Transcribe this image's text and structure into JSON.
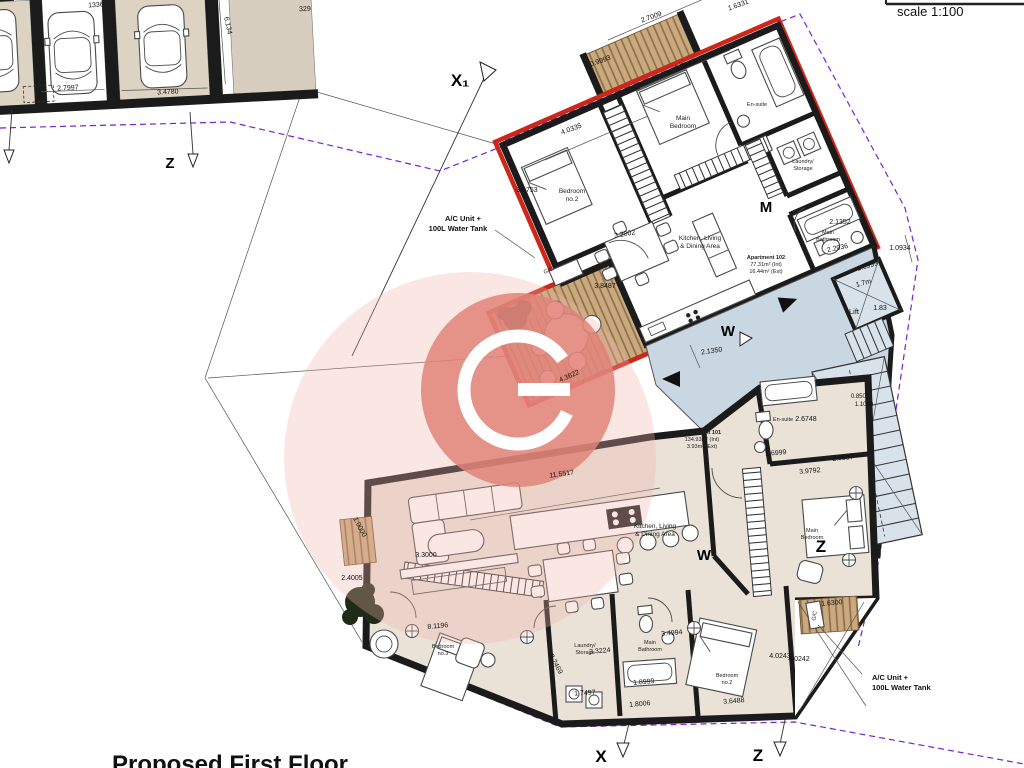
{
  "title": "Proposed First Floor",
  "scale_label": "scale 1:100",
  "markers": {
    "x1": "X₁",
    "z_top": "Z",
    "m": "M",
    "w_upper": "W",
    "w_lower": "W",
    "z_right": "Z",
    "x_bottom": "X",
    "z_bottom": "Z"
  },
  "apartments": {
    "apt102": {
      "name": "Apartment 102",
      "area_int": "77.31m² (Int)",
      "area_ext": "16.44m² (Ext)"
    },
    "apt101": {
      "name": "Apartment 101",
      "area_int": "134.93m² (Int)",
      "area_ext": "3.93m² (Ext)"
    }
  },
  "rooms": {
    "upper": {
      "bedroom2_l1": "Bedroom",
      "bedroom2_l2": "no.2",
      "main_bedroom_l1": "Main",
      "main_bedroom_l2": "Bedroom",
      "ensuite": "En-suite",
      "laundry_l1": "Laundry/",
      "laundry_l2": "Storage",
      "bathroom_l1": "Main",
      "bathroom_l2": "Bathroom",
      "kitchen_l1": "Kitchen, Living",
      "kitchen_l2": "& Dining Area",
      "gc": "G/C"
    },
    "lower": {
      "bedroom2_l1": "Bedroom",
      "bedroom2_l2": "no.2",
      "bedroom3_l1": "Bedroom",
      "bedroom3_l2": "no.3",
      "main_bedroom_l1": "Main",
      "main_bedroom_l2": "Bedroom",
      "ensuite": "En-suite",
      "laundry_l1": "Laundry/",
      "laundry_l2": "Storage",
      "bathroom_l1": "Main",
      "bathroom_l2": "Bathroom",
      "kitchen_l1": "Kitchen, Living",
      "kitchen_l2": "& Dining Area",
      "gc": "G/C"
    },
    "lift": "Lift"
  },
  "annotations": {
    "ac_upper_l1": "A/C Unit +",
    "ac_upper_l2": "100L Water Tank",
    "ac_lower_l1": "A/C Unit +",
    "ac_lower_l2": "100L Water Tank"
  },
  "dimensions": {
    "balcony_top_width": "2.7009",
    "balcony_top_side": "0.9993",
    "main_bedroom_top": "3.8740",
    "top_right_partial": "1.6331",
    "bedroom2_top": "4.0335",
    "bedroom2_side": "3.1753",
    "kitchen_top": "3.2002",
    "terrace_right": "3.8487",
    "terrace_width": "4.3622",
    "bathroom_up_a": "2.1352",
    "bathroom_up_b": "2.2036",
    "boundary_right": "1.0934",
    "landing_top": "1.6999",
    "lift_width": "1.7m",
    "lift_side": "1.83",
    "landing_width": "2.1350",
    "stair_a": "0.8509",
    "stair_b": "1.1050",
    "stair_width": "2.0507",
    "hall_lower": "1.6999",
    "bedroom_lower_top": "3.9792",
    "ensuite_lower": "2.6748",
    "living_length": "11.5517",
    "living_width": "3.3000",
    "balcony_left_a": "1.0000",
    "balcony_left_b": "2.4005",
    "bedroom3_length": "8.1196",
    "bedroom3_side": "2.2469",
    "laundry_lower_w": "3.3224",
    "bathroom_lower_w": "3.4994",
    "laundry_lower_d": "1.7497",
    "bathroom_lower_d": "1.8999",
    "hall_lower_d": "1.8006",
    "bedroom2_lower_w": "3.6488",
    "terrace_lower_a": "4.0243",
    "terrace_lower_b": "4.0242",
    "terrace_lower_w": "1.6300",
    "stall2_width": "2.7997",
    "stall3_width": "3.4780",
    "garage_depth": "6.134",
    "garage_a": "329",
    "garage_b": "1336"
  },
  "colors": {
    "new_wall_red": "#cf261a",
    "boundary_purple": "#7a22cc",
    "landing_blue": "#c9d7e2",
    "floor_beige": "#eae2d7",
    "deck_wood": "#c9aa7e",
    "watermark_pink": "#e18479"
  }
}
